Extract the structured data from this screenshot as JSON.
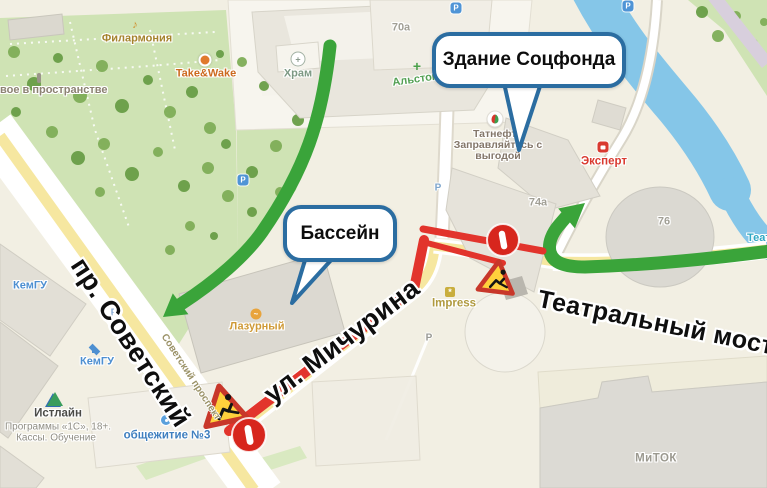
{
  "callouts": {
    "socfond": "Здание Соцфонда",
    "bassein": "Бассейн"
  },
  "annotations": {
    "sovetsky": "пр. Советский",
    "michurina": "ул. Мичурина",
    "bridge": "Театральный мост"
  },
  "pois": {
    "filarmonia": "Филармония",
    "takewake": "Take&Wake",
    "prostranstvo": "вое в пространстве",
    "hram": "Храм",
    "b70a": "70a",
    "alstom": "Альстом-Фар",
    "tatneft_name": "Татнефть",
    "tatneft_sub1": "Заправляйтесь с",
    "tatneft_sub2": "выгодой",
    "expert": "Эксперт",
    "b74a": "74a",
    "b76": "76",
    "teat": "Теат",
    "lazurny": "Лазурный",
    "impress": "Impress",
    "kemgu_upper": "КемГУ",
    "kemgu_lower": "КемГУ",
    "istlain_name": "Истлайн",
    "istlain_line1": "Программы «1С», 18+.",
    "istlain_line2": "Кассы. Обучение",
    "obshchezhitie": "общежитие №3",
    "mitok": "МиТОК",
    "prospekt_small": "Советский проспект",
    "parking": "P",
    "hram_cross": "+",
    "pharmacy_cross": "+"
  },
  "colors": {
    "callout_border": "#2b6da1",
    "arrow_green": "#3aa43a",
    "closure_red": "#e2342c",
    "no_entry_red": "#d7261d",
    "sign_yellow": "#ffd03c",
    "sign_border_red": "#c8372a",
    "water_blue": "#85c6e8",
    "road_yellow": "#f6e7a0",
    "park_green": "#cfe3b4"
  }
}
